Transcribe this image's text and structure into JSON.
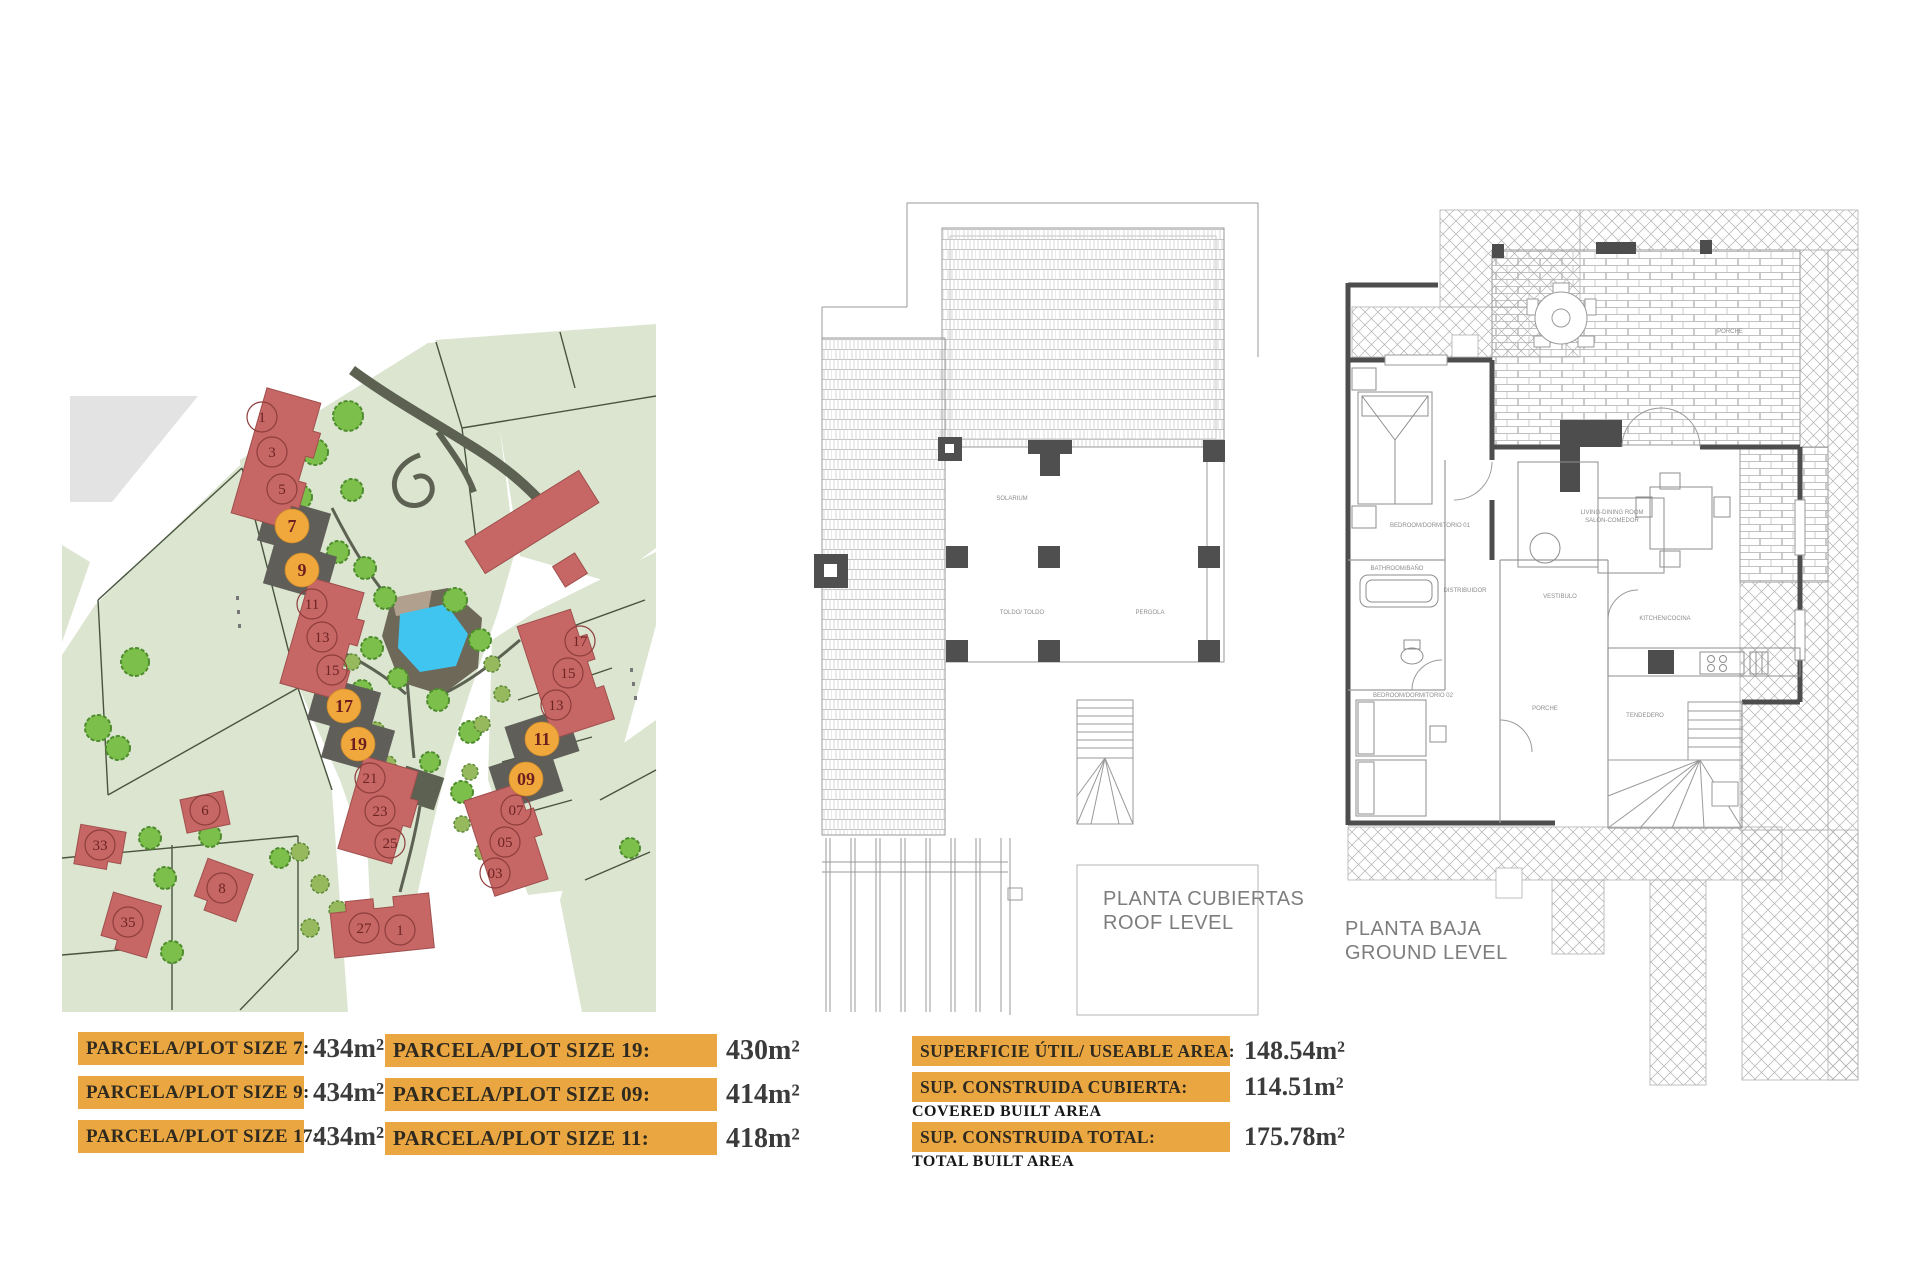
{
  "colors": {
    "orange": "#eaa640",
    "badge": "#f0a73c",
    "building_red": "#c76765",
    "plot_dark": "#5f5e59",
    "parcel_green": "#dbe5d0",
    "water_blue": "#40c5f0",
    "value_text": "#3b3b3b",
    "caption_gray": "#7d7d7d"
  },
  "site_plan": {
    "plots": {
      "n1": "1",
      "n3": "3",
      "n5": "5",
      "b7": "7",
      "b9": "9",
      "n11": "11",
      "n13": "13",
      "n15": "15",
      "b17": "17",
      "b19": "19",
      "n21": "21",
      "n23": "23",
      "n25": "25",
      "n27": "27",
      "n1b": "1",
      "r17": "17",
      "r15": "15",
      "r13": "13",
      "b11": "11",
      "b09": "09",
      "r07": "07",
      "r05": "05",
      "r03": "03",
      "a33": "33",
      "a35": "35",
      "a6": "6",
      "a8": "8"
    }
  },
  "roof_plan": {
    "caption_es": "PLANTA CUBIERTAS",
    "caption_en": "ROOF LEVEL",
    "labels": {
      "solarium": "SOLARIUM",
      "toldo": "TOLDO/ TOLDO",
      "pergola": "PERGOLA"
    }
  },
  "ground_plan": {
    "caption_es": "PLANTA BAJA",
    "caption_en": "GROUND LEVEL",
    "rooms": {
      "bedroom1": "BEDROOM/DORMITORIO 01",
      "living1": "LIVING-DINING ROOM",
      "living2": "SALON-COMEDOR",
      "kitchen": "KITCHEN/COCINA",
      "bath": "BATHROOM/BAÑO",
      "hall": "DISTRIBUIDOR",
      "vestibule": "VESTIBULO",
      "bedroom2": "BEDROOM/DORMITORIO 02",
      "porch_top": "PORCHE",
      "porch_bottom": "PORCHE",
      "laundry": "TENDEDERO"
    }
  },
  "plot_sizes": {
    "col1": [
      {
        "label": "PARCELA/PLOT SIZE 7:",
        "value": "434m²"
      },
      {
        "label": "PARCELA/PLOT SIZE 9:",
        "value": "434m²"
      },
      {
        "label": "PARCELA/PLOT SIZE 17:",
        "value": "434m²"
      }
    ],
    "col2": [
      {
        "label": "PARCELA/PLOT SIZE 19:",
        "value": "430m²"
      },
      {
        "label": "PARCELA/PLOT SIZE 09:",
        "value": "414m²"
      },
      {
        "label": "PARCELA/PLOT SIZE 11:",
        "value": "418m²"
      }
    ]
  },
  "areas": [
    {
      "label": "SUPERFICIE ÚTIL/ USEABLE AREA:",
      "sub": "",
      "value": "148.54m²"
    },
    {
      "label": "SUP. CONSTRUIDA CUBIERTA:",
      "sub": "COVERED BUILT AREA",
      "value": "114.51m²"
    },
    {
      "label": "SUP. CONSTRUIDA TOTAL:",
      "sub": "TOTAL BUILT AREA",
      "value": "175.78m²"
    }
  ]
}
